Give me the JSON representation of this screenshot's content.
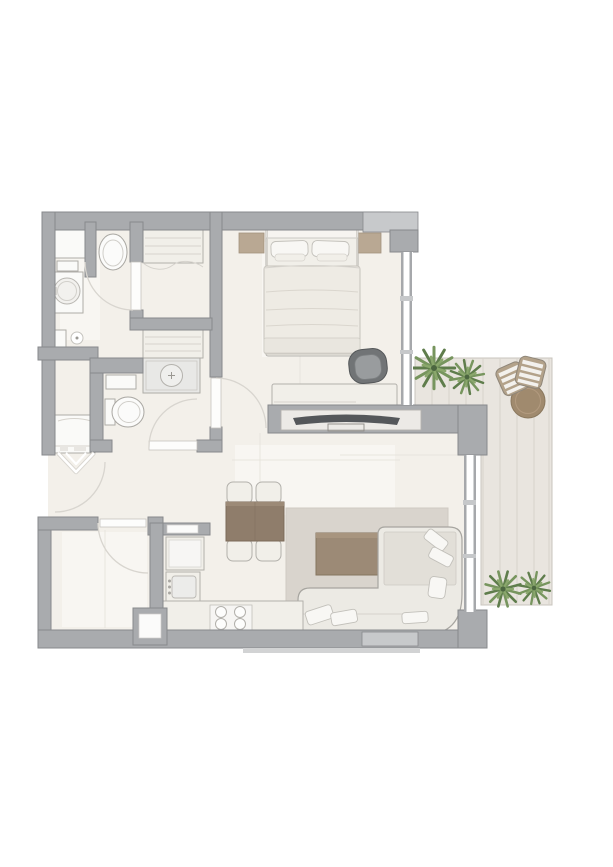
{
  "meta": {
    "type": "apartment-floor-plan",
    "description": "Top-down rendered floor plan of a one-bedroom apartment with bathroom, shower room, WC, walk-in wardrobe, storage room, open kitchen / dining / living area, bedroom zone and an L-shaped timber-deck terrace",
    "visible_text": []
  },
  "palette": {
    "page_bg": "#ffffff",
    "wall": "#a9abae",
    "wall_edge": "#87898c",
    "wall_light": "#c7c9cb",
    "floor": "#f3f0ea",
    "floor_seam": "#e6e3db",
    "deck": "#e9e5df",
    "deck_seam": "#d7d2cb",
    "furniture_light": "#f1efe9",
    "furniture_edge": "#b2b0ab",
    "wood_dark": "#8f7d6b",
    "wood_mid": "#9c8a76",
    "rug": "#d9d4cd",
    "accent_beige": "#b9a893",
    "tv_dark": "#54575a",
    "chair_dark": "#717476",
    "plant_dark": "#5f7d4c",
    "plant_mid": "#77955e",
    "plant_light": "#8aa76c",
    "door_arc": "#d8d5cf",
    "fixture_edge": "#aeaca7"
  },
  "rooms": [
    {
      "id": "entry-hall",
      "furniture": [
        "entry-door-swing",
        "entry-chevron-marks",
        "washing-machine"
      ]
    },
    {
      "id": "bathroom",
      "furniture": [
        "toilet",
        "washbasin-vanity",
        "storage-cabinet",
        "shelf",
        "floor-drain",
        "wall-tap"
      ]
    },
    {
      "id": "shower-room",
      "furniture": [
        "shower-tray",
        "door-swing"
      ]
    },
    {
      "id": "wc",
      "furniture": [
        "toilet",
        "washbasin",
        "door-swing"
      ]
    },
    {
      "id": "walk-in-wardrobe",
      "furniture": [
        "wardrobe-upper",
        "wardrobe-lower"
      ]
    },
    {
      "id": "storage-room",
      "furniture": [
        "door-swing",
        "service-shaft"
      ]
    },
    {
      "id": "kitchen",
      "furniture": [
        "fridge",
        "sink",
        "counter",
        "cooktop-4-burners",
        "pass-through-niche"
      ]
    },
    {
      "id": "dining-area",
      "furniture": [
        "dining-table",
        "dining-chair",
        "dining-chair",
        "dining-chair",
        "dining-chair"
      ]
    },
    {
      "id": "living-area",
      "furniture": [
        "corner-sofa",
        "sofa-pillows",
        "coffee-table",
        "area-rug",
        "tv-console",
        "tv",
        "window-wall"
      ]
    },
    {
      "id": "bedroom",
      "furniture": [
        "double-bed",
        "bed-pillows",
        "bedside-rug-left",
        "bedside-rug-right",
        "desk",
        "desk-chair",
        "window-wall"
      ]
    },
    {
      "id": "terrace",
      "furniture": [
        "timber-deck",
        "round-table",
        "outdoor-chair",
        "outdoor-chair",
        "plant",
        "plant",
        "plant",
        "plant"
      ]
    }
  ]
}
